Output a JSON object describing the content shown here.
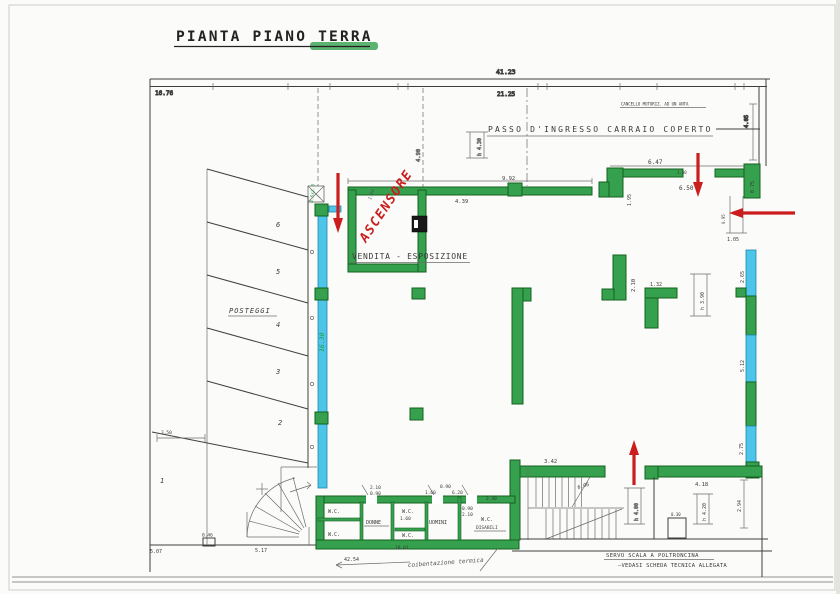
{
  "colors": {
    "wall_green": "#35a14e",
    "wall_cyan": "#4cc5e8",
    "arrow_red": "#cb1d1d",
    "hand_green": "#1f9e43",
    "ink": "#3f3f3f"
  },
  "labels": {
    "title": "PIANTA PIANO TERRA",
    "passo": "PASSO D'INGRESSO CARRAIO COPERTO",
    "gate_note1": "2x1.30",
    "gate_note2": "CANCELLO MOTORIZ. AD UN ANTA",
    "ascensore": "ASCENSORE",
    "vendita": "VENDITA - ESPOSIZIONE",
    "posteggi": "POSTEGGI",
    "servo1": "SERVO SCALA A POLTRONCINA",
    "servo2": "—VEDASI SCHEDA TECNICA ALLEGATA",
    "coibentazione": "coibentazione termica",
    "wc": "W.C.",
    "donne": "DONNE",
    "uomini": "UOMINI",
    "disabili": "DISABILI"
  },
  "stalls": [
    "6",
    "5",
    "4",
    "3",
    "2",
    "1"
  ],
  "dims": {
    "top_total": "41.23",
    "top_partial": "21.25",
    "left_top": "16.76",
    "gate_height": "4.05",
    "drive_width": "4.90",
    "h430": "h 4.30",
    "d992": "9.92",
    "d439": "4.39",
    "d198": "1.98",
    "d647": "6.47",
    "d650": "6.50",
    "d150": "1.50",
    "d195": "1.95",
    "d075": "0.75",
    "d095": "0.95",
    "d105": "1.05",
    "d265": "2.65",
    "d512": "5.12",
    "d275": "2.75",
    "d210": "2.10",
    "d132": "1.32",
    "h390": "h 3.90",
    "d1630": "16.30",
    "col_note": "0.6x2.0",
    "d342": "3.42",
    "d606": "6.06",
    "h400": "h 4.00",
    "d418": "4.18",
    "h420": "h 4.20",
    "d294": "2.94",
    "d030": "0.30",
    "d350": "3.50",
    "d507": "5.07",
    "d046": "0.46",
    "d517": "5.17",
    "d4254": "42.54",
    "d1001": "10.01",
    "wc_a": "2.10",
    "wc_b": "0.90",
    "wc_c": "0.90",
    "wc_d": "6.20",
    "wc_e": "1.60",
    "wc_f": "2.40",
    "wc_g": "1.60",
    "wc_h": "0.90",
    "wc_i": "2.10"
  }
}
